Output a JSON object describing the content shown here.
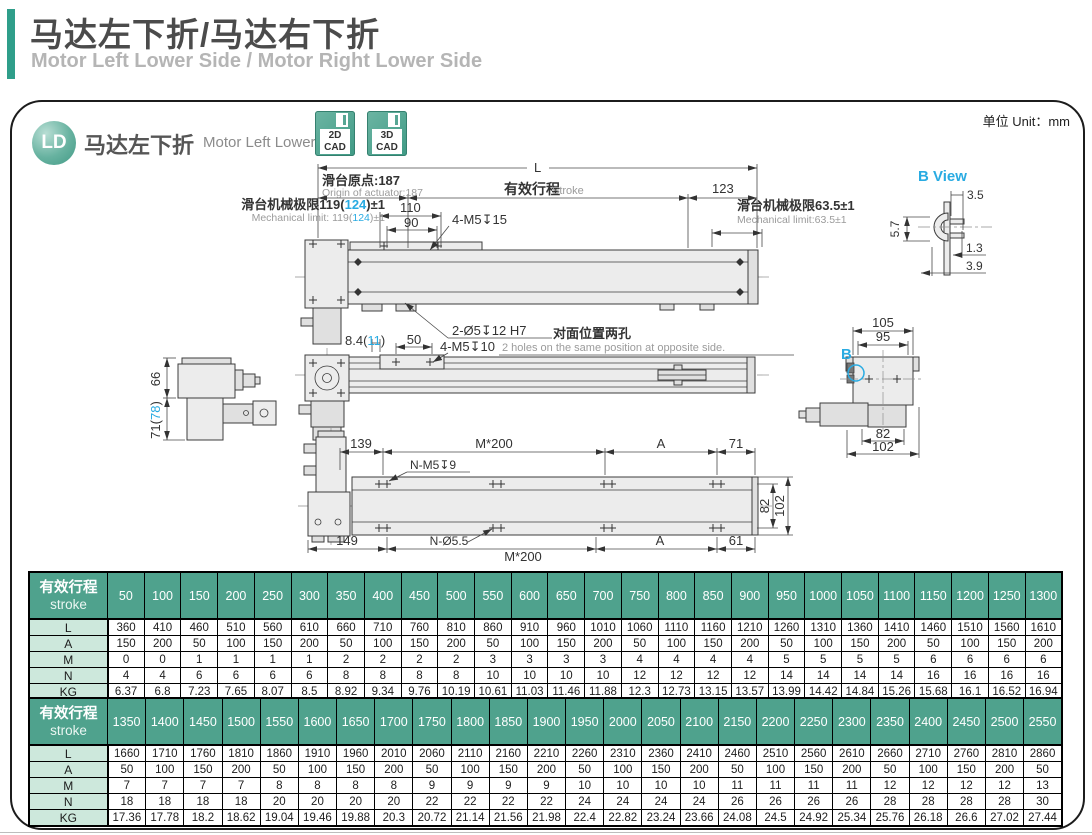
{
  "page": {
    "title_cn": "马达左下折/马达右下折",
    "title_en": "Motor Left Lower Side / Motor Right Lower Side",
    "unit": "单位 Unit：mm"
  },
  "panel": {
    "badge": "LD",
    "model_cn": "马达左下折",
    "model_en": "Motor Left Lower Side",
    "cad2d": {
      "l1": "2D",
      "l2": "CAD"
    },
    "cad3d": {
      "l1": "3D",
      "l2": "CAD"
    }
  },
  "drawing": {
    "accent": "#29abe2",
    "top": {
      "L": "L",
      "origin_cn": "滑台原点:187",
      "origin_en": "Origin of actuator:187",
      "stroke_cn": "有效行程",
      "stroke_en": "Stroke",
      "d123": "123",
      "lim_l_cn_pre": "滑台机械极限119(",
      "lim_l_hl": "124",
      "lim_l_suf": ")±1",
      "lim_l_en_pre": "Mechanical limit: 119(",
      "lim_l_en_hl": "124",
      "lim_l_en_suf": ")±1",
      "d110": "110",
      "d90": "90",
      "holes": "4-M5↧15",
      "pins": "2-Ø5↧12 H7",
      "lim_r_cn": "滑台机械极限63.5±1",
      "lim_r_en": "Mechanical limit:63.5±1"
    },
    "bview": {
      "title": "B View",
      "d35": "3.5",
      "d57": "5.7",
      "d13": "1.3",
      "d39": "3.9"
    },
    "mid": {
      "d84_pre": "8.4(",
      "d84_hl": "11",
      "d84_suf": ")",
      "d50": "50",
      "holes": "4-M5↧10",
      "note_cn": "对面位置两孔",
      "note_en": "2 holes on the same position at opposite side.",
      "d66": "66",
      "d71_pre": "71(",
      "d71_hl": "78",
      "d71_suf": ")",
      "b_mark": "B",
      "d105": "105",
      "d95": "95",
      "d82": "82",
      "d102": "102"
    },
    "bottom": {
      "d139": "139",
      "m200_top": "M*200",
      "a_top": "A",
      "d71": "71",
      "holes_top": "N-M5↧9",
      "d149": "149",
      "holes_bottom": "N-Ø5.5",
      "m200_bottom": "M*200",
      "a_bottom": "A",
      "d61": "61",
      "d82": "82",
      "d102": "102"
    }
  },
  "tables": [
    {
      "header_cn": "有效行程",
      "header_en": "stroke",
      "strokes": [
        50,
        100,
        150,
        200,
        250,
        300,
        350,
        400,
        450,
        500,
        550,
        600,
        650,
        700,
        750,
        800,
        850,
        900,
        950,
        1000,
        1050,
        1100,
        1150,
        1200,
        1250,
        1300
      ],
      "rows": [
        {
          "label": "L",
          "values": [
            360,
            410,
            460,
            510,
            560,
            610,
            660,
            710,
            760,
            810,
            860,
            910,
            960,
            1010,
            1060,
            1110,
            1160,
            1210,
            1260,
            1310,
            1360,
            1410,
            1460,
            1510,
            1560,
            1610
          ]
        },
        {
          "label": "A",
          "values": [
            150,
            200,
            50,
            100,
            150,
            200,
            50,
            100,
            150,
            200,
            50,
            100,
            150,
            200,
            50,
            100,
            150,
            200,
            50,
            100,
            150,
            200,
            50,
            100,
            150,
            200
          ]
        },
        {
          "label": "M",
          "values": [
            0,
            0,
            1,
            1,
            1,
            1,
            2,
            2,
            2,
            2,
            3,
            3,
            3,
            3,
            4,
            4,
            4,
            4,
            5,
            5,
            5,
            5,
            6,
            6,
            6,
            6
          ]
        },
        {
          "label": "N",
          "values": [
            4,
            4,
            6,
            6,
            6,
            6,
            8,
            8,
            8,
            8,
            10,
            10,
            10,
            10,
            12,
            12,
            12,
            12,
            14,
            14,
            14,
            14,
            16,
            16,
            16,
            16
          ]
        },
        {
          "label": "KG",
          "values": [
            6.37,
            6.8,
            7.23,
            7.65,
            8.07,
            8.5,
            8.92,
            9.34,
            9.76,
            10.19,
            10.61,
            11.03,
            11.46,
            11.88,
            12.3,
            12.73,
            13.15,
            13.57,
            13.99,
            14.42,
            14.84,
            15.26,
            15.68,
            16.1,
            16.52,
            16.94
          ]
        }
      ]
    },
    {
      "header_cn": "有效行程",
      "header_en": "stroke",
      "strokes": [
        1350,
        1400,
        1450,
        1500,
        1550,
        1600,
        1650,
        1700,
        1750,
        1800,
        1850,
        1900,
        1950,
        2000,
        2050,
        2100,
        2150,
        2200,
        2250,
        2300,
        2350,
        2400,
        2450,
        2500,
        2550
      ],
      "rows": [
        {
          "label": "L",
          "values": [
            1660,
            1710,
            1760,
            1810,
            1860,
            1910,
            1960,
            2010,
            2060,
            2110,
            2160,
            2210,
            2260,
            2310,
            2360,
            2410,
            2460,
            2510,
            2560,
            2610,
            2660,
            2710,
            2760,
            2810,
            2860
          ]
        },
        {
          "label": "A",
          "values": [
            50,
            100,
            150,
            200,
            50,
            100,
            150,
            200,
            50,
            100,
            150,
            200,
            50,
            100,
            150,
            200,
            50,
            100,
            150,
            200,
            50,
            100,
            150,
            200,
            50
          ]
        },
        {
          "label": "M",
          "values": [
            7,
            7,
            7,
            7,
            8,
            8,
            8,
            8,
            9,
            9,
            9,
            9,
            10,
            10,
            10,
            10,
            11,
            11,
            11,
            11,
            12,
            12,
            12,
            12,
            13
          ]
        },
        {
          "label": "N",
          "values": [
            18,
            18,
            18,
            18,
            20,
            20,
            20,
            20,
            22,
            22,
            22,
            22,
            24,
            24,
            24,
            24,
            26,
            26,
            26,
            26,
            28,
            28,
            28,
            28,
            30
          ]
        },
        {
          "label": "KG",
          "values": [
            17.36,
            17.78,
            18.2,
            18.62,
            19.04,
            19.46,
            19.88,
            20.3,
            20.72,
            21.14,
            21.56,
            21.98,
            22.4,
            22.82,
            23.24,
            23.66,
            24.08,
            24.5,
            24.92,
            25.34,
            25.76,
            26.18,
            26.6,
            27.02,
            27.44
          ]
        }
      ]
    }
  ]
}
